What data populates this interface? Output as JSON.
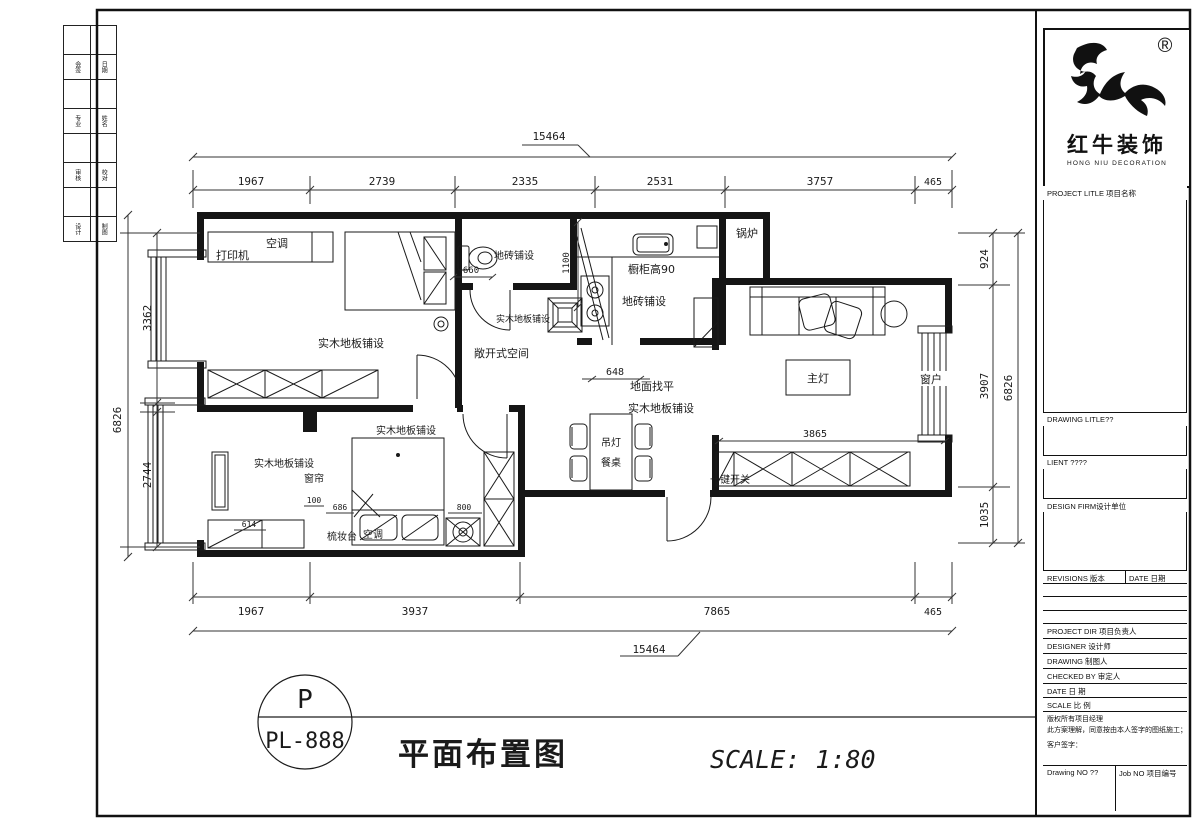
{
  "strip": {
    "labels": [
      "会签",
      "日期",
      "专业",
      "姓名",
      "审核",
      "校对",
      "设计",
      "制图"
    ]
  },
  "titleblock": {
    "reg": "®",
    "brand": "红牛装饰",
    "brand_en": "HONG NIU DECORATION",
    "project_title": "PROJECT LITLE 项目名称",
    "drawing_title": "DRAWING LITLE??",
    "client": "LIENT ????",
    "design_firm": "DESIGN FIRM设计单位",
    "revisions": "REVISIONS 版本",
    "date_col": "DATE 日期",
    "project_dir": "PROJECT DIR  项目负责人",
    "designer": "DESIGNER  设计师",
    "drawing": "DRAWING  制图人",
    "checked_by": "CHECKED BY  审定人",
    "date": "DATE  日 期",
    "scale": "SCALE  比 例",
    "note1": "版权所有项目经理",
    "note2": "此方案理解，同意按由本人签字的图纸施工；",
    "note3": "客户签字：",
    "drawing_no": "Drawing NO ??",
    "job_no": "Job NO 项目编号"
  },
  "plan": {
    "labels": {
      "printer": "打印机",
      "ac1": "空调",
      "tile_bath": "地砖铺设",
      "wood_room1": "实木地板铺设",
      "wood_hall": "实木地板铺设",
      "open_space": "敞开式空间",
      "boiler": "锅炉",
      "cabinet90": "橱柜高90",
      "tile_kitchen": "地砖铺设",
      "leveling": "地面找平",
      "wood_dining": "实木地板铺设",
      "main_light": "主灯",
      "window": "窗户",
      "wood_room2_top": "实木地板铺设",
      "wood_room2_left": "实木地板铺设",
      "curtain": "窗帘",
      "pendant": "吊灯",
      "table": "餐桌",
      "one_key": "一键开关",
      "dresser": "梳妆台",
      "ac2": "空调"
    }
  },
  "dims": {
    "top_overall": "15464",
    "top": [
      "1967",
      "2739",
      "2335",
      "2531",
      "3757",
      "465"
    ],
    "left_overall": "6826",
    "left": [
      "3362",
      "2744"
    ],
    "right": [
      "924",
      "3907",
      "1035"
    ],
    "right_overall": "6826",
    "bottom": [
      "1967",
      "3937",
      "7865",
      "465"
    ],
    "bottom_overall": "15464",
    "inner": {
      "d660": "660",
      "d1100": "1100",
      "d648": "648",
      "d3865": "3865",
      "d100": "100",
      "d686": "686",
      "d614": "614",
      "d800": "800"
    }
  },
  "footer": {
    "circle_top": "P",
    "circle_bottom": "PL-888",
    "title": "平面布置图",
    "scale": "SCALE: 1:80"
  }
}
